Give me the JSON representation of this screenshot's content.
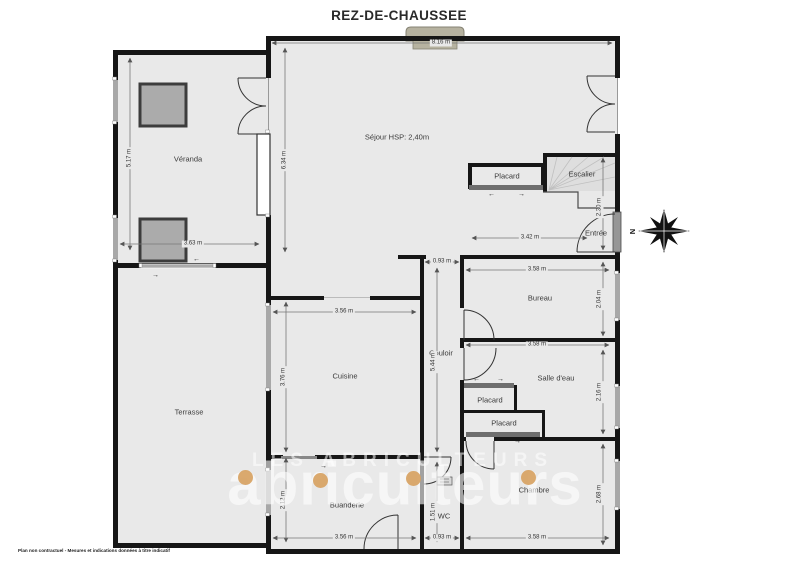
{
  "title": "REZ-DE-CHAUSSEE",
  "disclaimer": "Plan non contractuel - Mesures et indications données à titre indicatif",
  "compass": {
    "north_label": "N"
  },
  "watermark": {
    "line_small": "LES ABRICULTEURS",
    "line_large": "abriculteurs",
    "dot_color": "#D7A15F"
  },
  "symbols": {
    "arrow_left": "←",
    "arrow_right": "→"
  },
  "colors": {
    "floor": "#e9e9e9",
    "wall": "#161616",
    "window": "#a8a8a8",
    "chimney": "#b6b2a0",
    "accent_dot": "#D7A15F"
  },
  "rooms": {
    "veranda": {
      "label": "Véranda"
    },
    "sejour": {
      "label": "Séjour HSP: 2,40m"
    },
    "placard_sejour": {
      "label": "Placard"
    },
    "escalier": {
      "label": "Escalier"
    },
    "entree": {
      "label": "Entrée"
    },
    "bureau": {
      "label": "Bureau"
    },
    "couloir": {
      "label": "Couloir"
    },
    "cuisine": {
      "label": "Cuisine"
    },
    "salle_eau": {
      "label": "Salle d'eau"
    },
    "placard_haut": {
      "label": "Placard"
    },
    "placard_bas": {
      "label": "Placard"
    },
    "terrasse": {
      "label": "Terrasse"
    },
    "buanderie": {
      "label": "Buanderie"
    },
    "wc": {
      "label": "WC"
    },
    "chambre": {
      "label": "Chambre"
    }
  },
  "dims": {
    "top_sejour": "8.16 m",
    "veranda_h": "5.17 m",
    "veranda_w": "3.63 m",
    "sejour_h": "6.34 m",
    "escalier_h": "2.30 m",
    "entree_w": "3.42 m",
    "couloir_w": "0.93 m",
    "bureau_w": "3.58 m",
    "bureau_h": "2.04 m",
    "salle_eau_w": "3.58 m",
    "salle_eau_h": "2.16 m",
    "cuisine_w": "3.56 m",
    "cuisine_h": "3.76 m",
    "couloir_h": "5.44 m",
    "chambre_h": "2.68 m",
    "buanderie_h": "2.12 m",
    "wc_h": "1.51 m",
    "buanderie_w": "3.56 m",
    "wc_w": "0.93 m",
    "chambre_w": "3.58 m"
  }
}
